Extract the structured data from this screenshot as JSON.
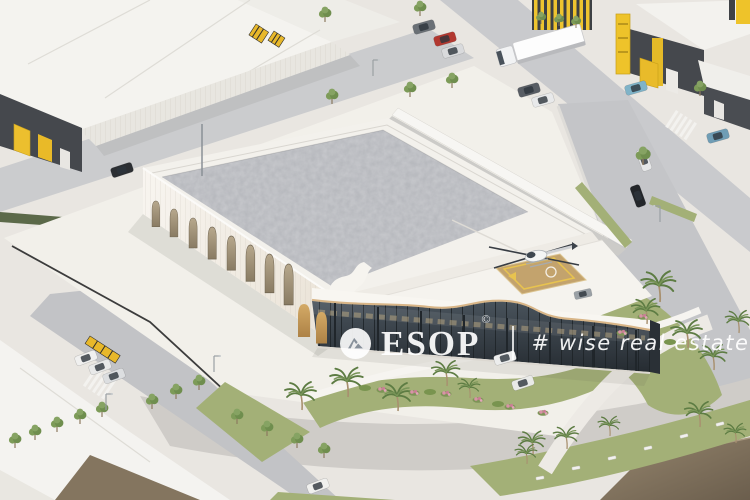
{
  "meta": {
    "asset_type": "3d-architectural-render",
    "view": "aerial-isometric",
    "width_px": 750,
    "height_px": 500
  },
  "watermark": {
    "logo_icon": "esop-peak-circle-icon",
    "brand": "ESOP",
    "copyright_symbol": "©",
    "tagline": "# wise real estate advice",
    "text_color": "#ffffff"
  },
  "scene": {
    "description": "Aerial isometric 3D rendering of an industrial park: a white showroom-warehouse with arched windows, a wavy glass entrance front and a rooftop helipad with helicopter stands on landscaped grounds with palm trees, lawns, flower beds and a curved driveway, surrounded by streets with cars, a semi-trailer truck and grey warehouse units with yellow accents",
    "main_building": "white warehouse-showroom with arched facade, glass front and rooftop helipad",
    "helicopter": "white helicopter parked on rooftop helipad",
    "neighbourhood": "grey logistics warehouses with yellow gates and pylons",
    "landscaping": "palm trees, lawns, pink flower beds, street trees and hedges",
    "traffic": "white semi-trailer truck, parked cars, moving cars, white pickup"
  },
  "palette": {
    "ground": "#e9e6e1",
    "road": "#c6c7ca",
    "roof_white": "#f4f3ef",
    "roof_grey": "#b5b7bc",
    "building_white": "#f6f3ee",
    "glass_dark": "#2e353c",
    "accent_yellow": "#eec32a",
    "lawn_green": "#a3b077",
    "palm_green": "#5f7f45",
    "helipad_tan": "#c3a36d",
    "wood_trim": "#d9b98c",
    "dark_facade": "#45484d",
    "brown_roof": "#82735f"
  }
}
